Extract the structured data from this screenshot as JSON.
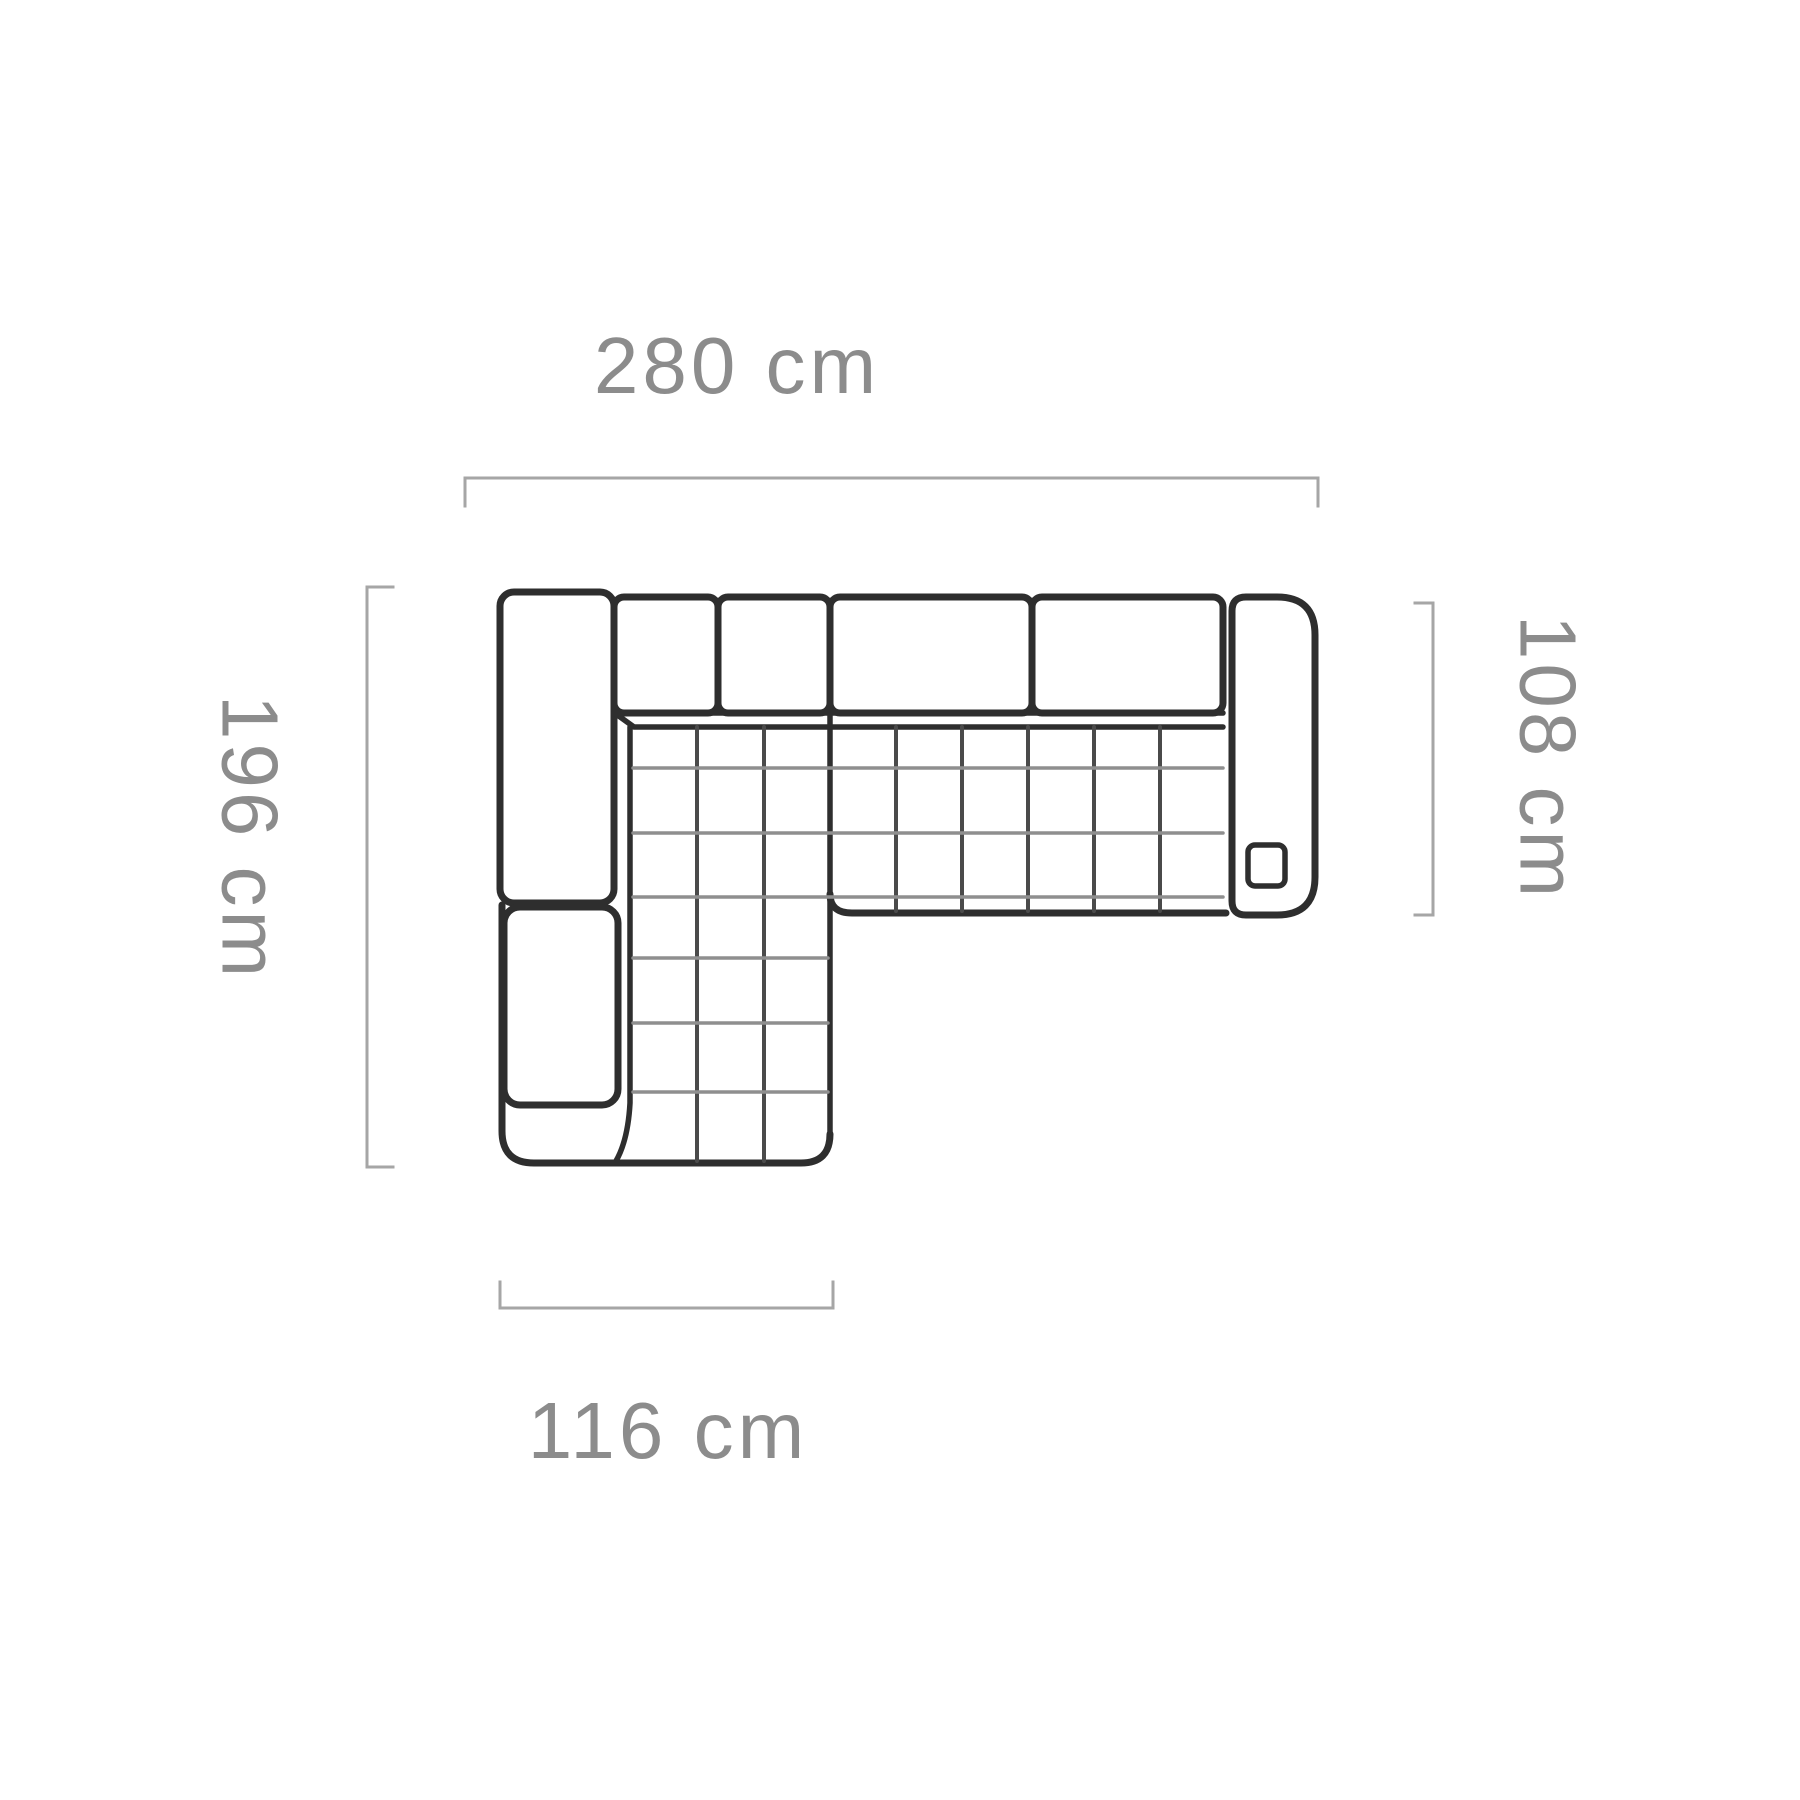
{
  "diagram": {
    "type": "furniture-top-view-dimension-diagram",
    "subject": "corner-sofa-with-left-chaise",
    "units": "cm"
  },
  "measurements": {
    "top_width": {
      "label": "280 cm",
      "value": 280,
      "unit": "cm",
      "side": "top"
    },
    "left_depth": {
      "label": "196 cm",
      "value": 196,
      "unit": "cm",
      "side": "left"
    },
    "right_depth": {
      "label": "108 cm",
      "value": 108,
      "unit": "cm",
      "side": "right"
    },
    "chaise_width": {
      "label": "116 cm",
      "value": 116,
      "unit": "cm",
      "side": "bottom"
    }
  },
  "parts": [
    "left-armrest",
    "left-side-cushion",
    "backrest-cushions",
    "right-armrest",
    "right-armrest-detail-square",
    "quilted-seat",
    "chaise-section"
  ],
  "colors": {
    "background": "#ffffff",
    "sofa_line": "#2e2e2e",
    "quilt_line_light": "#8f8f8f",
    "quilt_line_dark": "#4a4a4a",
    "dimension_line": "#a6a6a6",
    "label_text": "#8c8c8c"
  }
}
